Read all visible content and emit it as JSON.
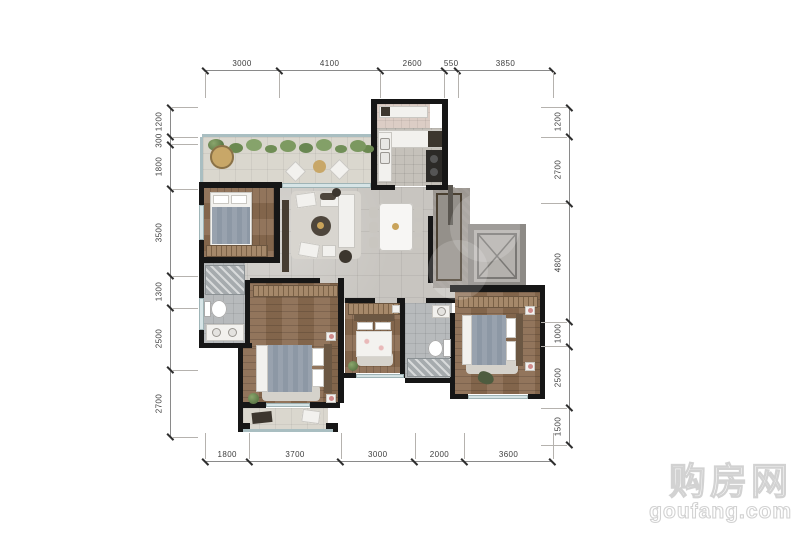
{
  "dimensions": {
    "top": [
      3000,
      4100,
      2600,
      550,
      3850
    ],
    "bottom": [
      1800,
      3700,
      3000,
      2000,
      3600
    ],
    "left": [
      1200,
      300,
      1800,
      3500,
      1300,
      2500,
      2700
    ],
    "right": [
      1200,
      2700,
      4800,
      1000,
      2500,
      1500
    ]
  },
  "watermark": {
    "name": "购房网",
    "domain": "goufang.com"
  },
  "palette": {
    "wall": "#161616",
    "wood": "#8a6b50",
    "tile": "#c8c5c0",
    "bathtile": "#b7babc",
    "kitchentile": "#c5c1ba",
    "balconytile": "#dad7ce",
    "utilitytile": "#dccdc5",
    "glass": "#d6e4e6",
    "wardrobe": "#a5886a",
    "blanket": "#8d98a5",
    "greenery": "#7a9560",
    "gold": "#c9a35a",
    "lamp_pink": "#cf8a8a",
    "dim_line": "#8a8a8a",
    "dim_text": "#3d3d3d",
    "watermark_gray": "#d2d2d2"
  }
}
